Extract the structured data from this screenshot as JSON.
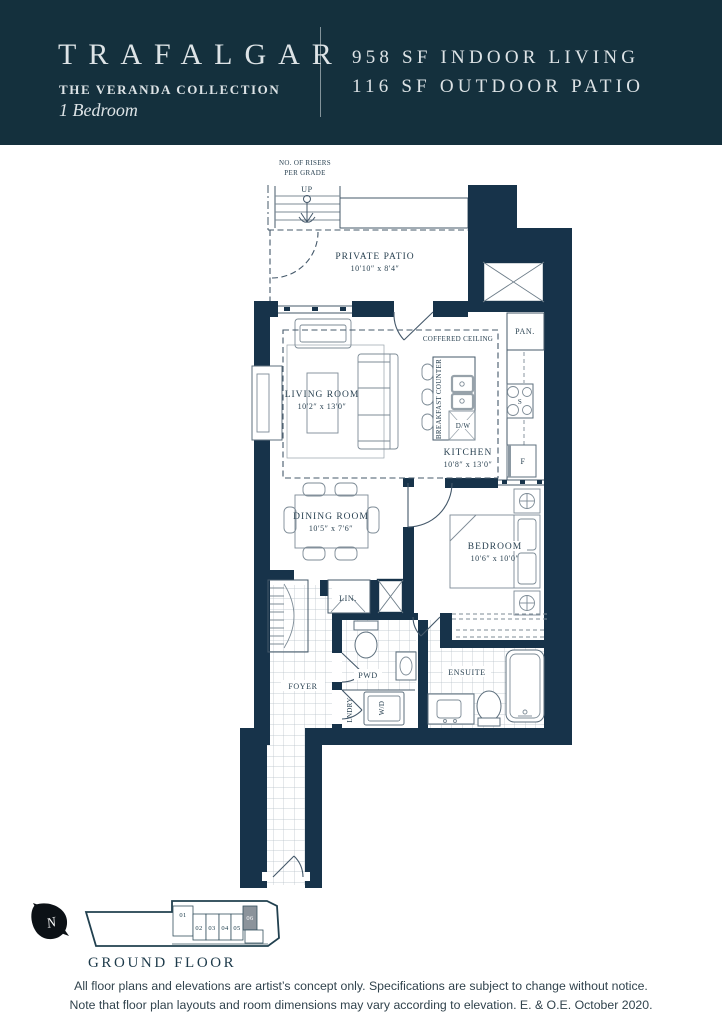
{
  "header": {
    "title": "TRAFALGAR",
    "collection": "THE VERANDA COLLECTION",
    "unit_type": "1 Bedroom",
    "indoor": "958 SF INDOOR LIVING",
    "outdoor": "116 SF OUTDOOR PATIO"
  },
  "plan": {
    "stairs": {
      "note_line1": "NO. OF RISERS",
      "note_line2": "PER GRADE",
      "up": "UP"
    },
    "rooms": {
      "patio": {
        "name": "PRIVATE PATIO",
        "dims": "10′10″ x 8′4″"
      },
      "living": {
        "name": "LIVING ROOM",
        "dims": "10′2″ x 13′0″"
      },
      "kitchen": {
        "name": "KITCHEN",
        "dims": "10′8″ x 13′0″"
      },
      "dining": {
        "name": "DINING ROOM",
        "dims": "10′5″ x 7′6″"
      },
      "bedroom": {
        "name": "BEDROOM",
        "dims": "10′6″ x 10′0″"
      },
      "ensuite": {
        "name": "ENSUITE"
      },
      "foyer": {
        "name": "FOYER"
      },
      "pwd": {
        "name": "PWD"
      },
      "laundry": {
        "name": "LNDRY"
      }
    },
    "labels": {
      "coffered_ceiling": "COFFERED CEILING",
      "breakfast_counter": "BREAKFAST COUNTER",
      "pantry": "PAN.",
      "linen": "LIN.",
      "dishwasher": "D/W",
      "fridge": "F",
      "stove": "S",
      "washer_dryer": "W/D"
    }
  },
  "keyplan": {
    "floor_label": "GROUND FLOOR",
    "north": "N",
    "units": [
      "01",
      "02",
      "03",
      "04",
      "05",
      "06"
    ],
    "highlighted_unit": "06"
  },
  "footer": {
    "line1": "All floor plans and elevations are artist’s concept only. Specifications are subject to change without notice.",
    "line2": "Note that floor plan layouts and room dimensions may vary according to elevation. E. & O.E. October 2020."
  },
  "colors": {
    "banner": "#14303d",
    "wall": "#17334a",
    "highlight_unit": "#8b939b"
  }
}
